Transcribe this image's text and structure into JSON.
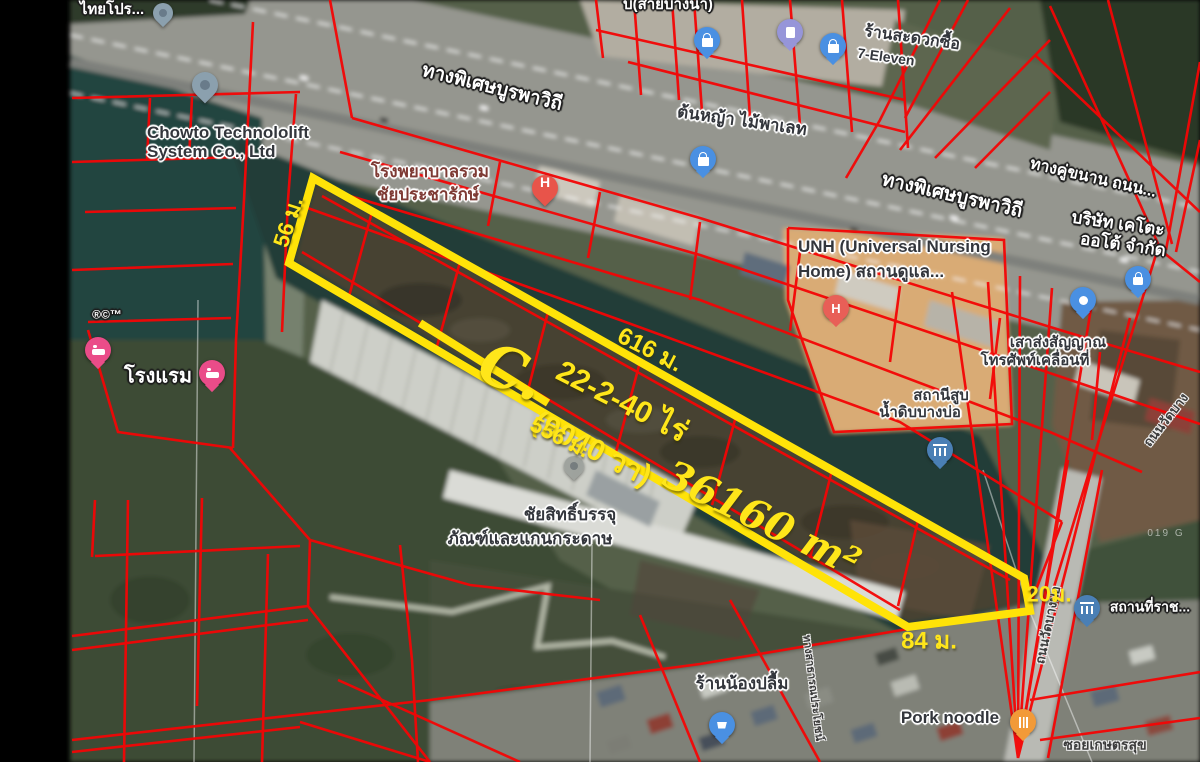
{
  "map": {
    "kind": "satellite-with-cadastral-overlay",
    "colors": {
      "cadastral_line": "#f40505",
      "parcel_outline": "#ffe308",
      "annotation_text": "#ffe61a",
      "water": "#223e39",
      "background_margin": "#000000"
    }
  },
  "parcel": {
    "code": "C.",
    "area_rai": "22-2-40 ไร่",
    "area_wa": "(9040 วา)",
    "area_sqm": "36160 m²",
    "dim_west": "56 ม.",
    "dim_north": "616 ม.",
    "dim_south": "556 ม.",
    "dim_east": "20ม.",
    "dim_south_tail": "84 ม."
  },
  "labels": {
    "thai_pro": "ไทยโปร...",
    "sai_bangna": "บ(สายบางนา)",
    "expressway": "ทางพิเศษบูรพาวิถี",
    "parallel_road": "ทางคู่ขนาน ถนน...",
    "chowto1": "Chowto Technololift",
    "chowto2": "System Co., Ltd",
    "grass_pallet": "ต้นหญ้า ไม้พาเลท",
    "conv_store": "ร้านสะดวกซื้อ",
    "seven_eleven": "7-Eleven",
    "hospital1": "โรงพยาบาลรวม",
    "hospital2": "ชัยประชารักษ์",
    "unh1": "UNH (Universal Nursing",
    "unh2": "Home) สถานดูแล...",
    "keto1": "บริษัท เคโตะ",
    "keto2": "ออโต้ จำกัด",
    "tower1": "เสาส่งสัญญาณ",
    "tower2": "โทรศัพท์เคลื่อนที่",
    "pump_station1": "สถานีสูบ",
    "pump_station2": "น้ำดิบบางบ่อ",
    "hotel": "โรงแรม",
    "trademark": "®©™",
    "chaiyasit1": "ชัยสิทธิ์บรรจุ",
    "chaiyasit2": "ภัณฑ์และแกนกระดาษ",
    "nongplum": "ร้านน้องปลื้ม",
    "pork_noodle": "Pork noodle",
    "soi_kaset": "ซอยเกษตรสุข",
    "gov_place": "สถานที่ราช...",
    "road_watbangbo": "ถนนวัดบางบ่อ",
    "road_watbang": "ถนนวัดบาง",
    "public_way": "ทางสาธารณประโยชน์",
    "watermark": "019 G"
  },
  "pins": {
    "chowto": "place-pin",
    "topleft": "place-pin",
    "hospital": "hospital-h-pin",
    "dropped": "dropped-gray-pin",
    "shop_a": "shopping-bag-pin",
    "gas": "gas-station-pin",
    "shop_b": "shopping-bag-pin",
    "shop_pallet": "shopping-bag-pin",
    "unh": "hospital-h-pin",
    "tower": "blue-dot-pin",
    "lock": "lock-pin",
    "pump_station": "government-building-pin",
    "gov": "government-building-pin",
    "hotel_a": "hotel-bed-pin",
    "hotel_b": "hotel-bed-pin",
    "cart": "shopping-cart-pin",
    "food": "restaurant-pin"
  }
}
